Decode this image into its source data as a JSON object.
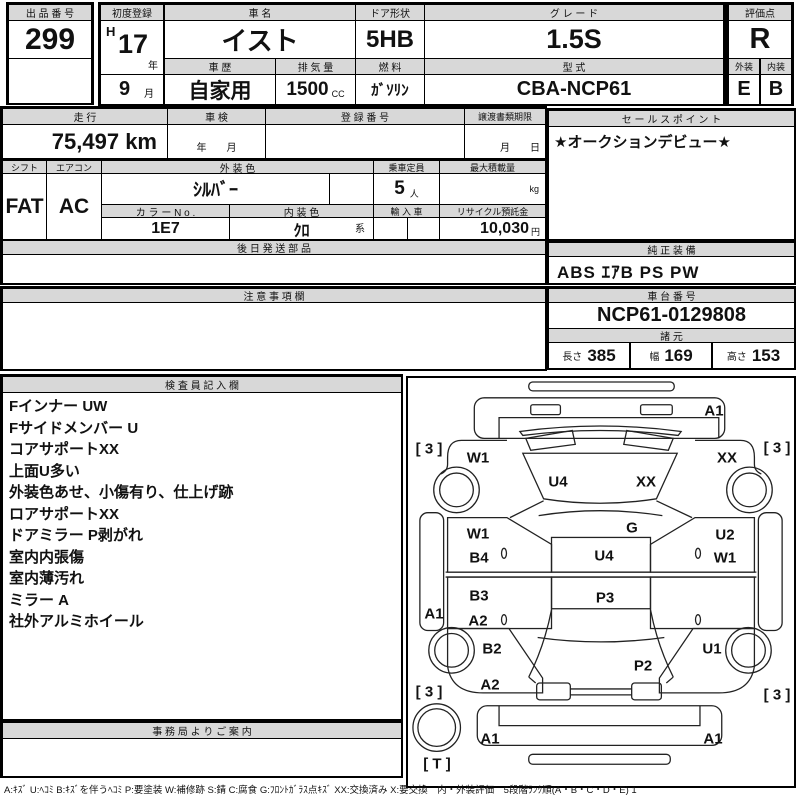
{
  "colors": {
    "header_bg": "#d8d8d8",
    "border": "#000000",
    "text": "#111111"
  },
  "top": {
    "auction_no": {
      "label": "出 品 番 号",
      "value": "299"
    },
    "first_reg": {
      "label": "初度登録",
      "era": "H",
      "year": "17",
      "year_unit": "年",
      "month": "9",
      "month_unit": "月"
    },
    "car_name": {
      "label": "車  名",
      "value": "イスト"
    },
    "door": {
      "label": "ドア形状",
      "value": "5HB"
    },
    "grade": {
      "label": "グ レ ー ド",
      "value": "1.5S"
    },
    "score": {
      "label": "評価点",
      "value": "R"
    },
    "history": {
      "label": "車 歴",
      "value": "自家用"
    },
    "displacement": {
      "label": "排 気 量",
      "value": "1500",
      "unit": "CC"
    },
    "fuel": {
      "label": "燃 料",
      "value": "ｶﾞｿﾘﾝ"
    },
    "model": {
      "label": "型 式",
      "value": "CBA-NCP61"
    },
    "exterior": {
      "label": "外装",
      "value": "E"
    },
    "interior": {
      "label": "内装",
      "value": "B"
    }
  },
  "band2": {
    "mileage": {
      "label": "走 行",
      "value": "75,497 km"
    },
    "shaken": {
      "label": "車 検",
      "value": "年　　月"
    },
    "reg_no": {
      "label": "登 録 番 号",
      "value": ""
    },
    "transfer": {
      "label": "譲渡書類期限",
      "value": "月　　日"
    }
  },
  "band3": {
    "shift": {
      "label": "シフト",
      "value": "FAT"
    },
    "aircon": {
      "label": "エアコン",
      "value": "AC"
    },
    "ext_color": {
      "label": "外 装 色",
      "value": "ｼﾙﾊﾞｰ"
    },
    "capacity": {
      "label": "乗車定員",
      "value": "5",
      "unit": "人"
    },
    "max_load": {
      "label": "最大積載量",
      "value": "",
      "unit": "kg"
    },
    "color_no": {
      "label": "カ ラ ー N o .",
      "value": "1E7"
    },
    "int_color": {
      "label": "内 装 色",
      "value": "ｸﾛ",
      "suffix": "系"
    },
    "import_car": {
      "label": "輸 入 車",
      "value": ""
    },
    "recycle": {
      "label": "リサイクル預託金",
      "value": "10,030",
      "unit": "円"
    }
  },
  "later_parts": {
    "label": "後 日 発 送 部 品",
    "value": ""
  },
  "caution": {
    "label": "注 意 事 項 欄",
    "value": ""
  },
  "sales_point": {
    "label": "セ ー ル ス ポ イ ン ト",
    "value": "★オークションデビュー★"
  },
  "equipment": {
    "label": "純 正 装 備",
    "value": "ABS ｴｱB PS PW"
  },
  "chassis": {
    "label": "車 台 番 号",
    "value": "NCP61-0129808"
  },
  "dimensions": {
    "label": "諸 元",
    "items": [
      {
        "k": "長さ",
        "v": "385"
      },
      {
        "k": "幅",
        "v": "169"
      },
      {
        "k": "高さ",
        "v": "153"
      }
    ]
  },
  "inspector": {
    "label": "検 査 員 記 入 欄",
    "lines": [
      "Fインナー UW",
      "Fサイドメンバー U",
      "コアサポートXX",
      "上面U多い",
      "外装色あせ、小傷有り、仕上げ跡",
      "ロアサポートXX",
      "ドアミラー P剥がれ",
      "室内内張傷",
      "室内薄汚れ",
      "ミラー A",
      "社外アルミホイール"
    ]
  },
  "office": {
    "label": "事 務 局 よ り ご 案 内",
    "value": ""
  },
  "legend": "A:ｷｽﾞ U:ﾍｺﾐ B:ｷｽﾞを伴うﾍｺﾐ P:要塗装 W:補修跡 S:錆 C:腐食 G:ﾌﾛﾝﾄｶﾞﾗｽ点ｷｽﾞ XX:交換済み X:要交換　内・外装評価　5段階ﾗﾝｸ順(A・B・C・D・E) 1",
  "diagram": {
    "labels": [
      {
        "text": "A1",
        "x": 306,
        "y": 33
      },
      {
        "text": "[ 3 ]",
        "x": 21,
        "y": 71
      },
      {
        "text": "W1",
        "x": 70,
        "y": 80
      },
      {
        "text": "XX",
        "x": 319,
        "y": 80
      },
      {
        "text": "[ 3 ]",
        "x": 369,
        "y": 70
      },
      {
        "text": "U4",
        "x": 150,
        "y": 104
      },
      {
        "text": "XX",
        "x": 238,
        "y": 104
      },
      {
        "text": "G",
        "x": 224,
        "y": 150
      },
      {
        "text": "W1",
        "x": 70,
        "y": 156
      },
      {
        "text": "B4",
        "x": 71,
        "y": 180
      },
      {
        "text": "U2",
        "x": 317,
        "y": 157
      },
      {
        "text": "W1",
        "x": 317,
        "y": 180
      },
      {
        "text": "U4",
        "x": 196,
        "y": 178
      },
      {
        "text": "B3",
        "x": 71,
        "y": 218
      },
      {
        "text": "P3",
        "x": 197,
        "y": 220
      },
      {
        "text": "A1",
        "x": 26,
        "y": 236
      },
      {
        "text": "A2",
        "x": 70,
        "y": 243
      },
      {
        "text": "B2",
        "x": 84,
        "y": 271
      },
      {
        "text": "U1",
        "x": 304,
        "y": 271
      },
      {
        "text": "P2",
        "x": 235,
        "y": 288
      },
      {
        "text": "A2",
        "x": 82,
        "y": 307
      },
      {
        "text": "[ 3 ]",
        "x": 21,
        "y": 314
      },
      {
        "text": "[ 3 ]",
        "x": 369,
        "y": 317
      },
      {
        "text": "A1",
        "x": 82,
        "y": 361
      },
      {
        "text": "A1",
        "x": 305,
        "y": 361
      },
      {
        "text": "[ T ]",
        "x": 29,
        "y": 386
      }
    ]
  }
}
